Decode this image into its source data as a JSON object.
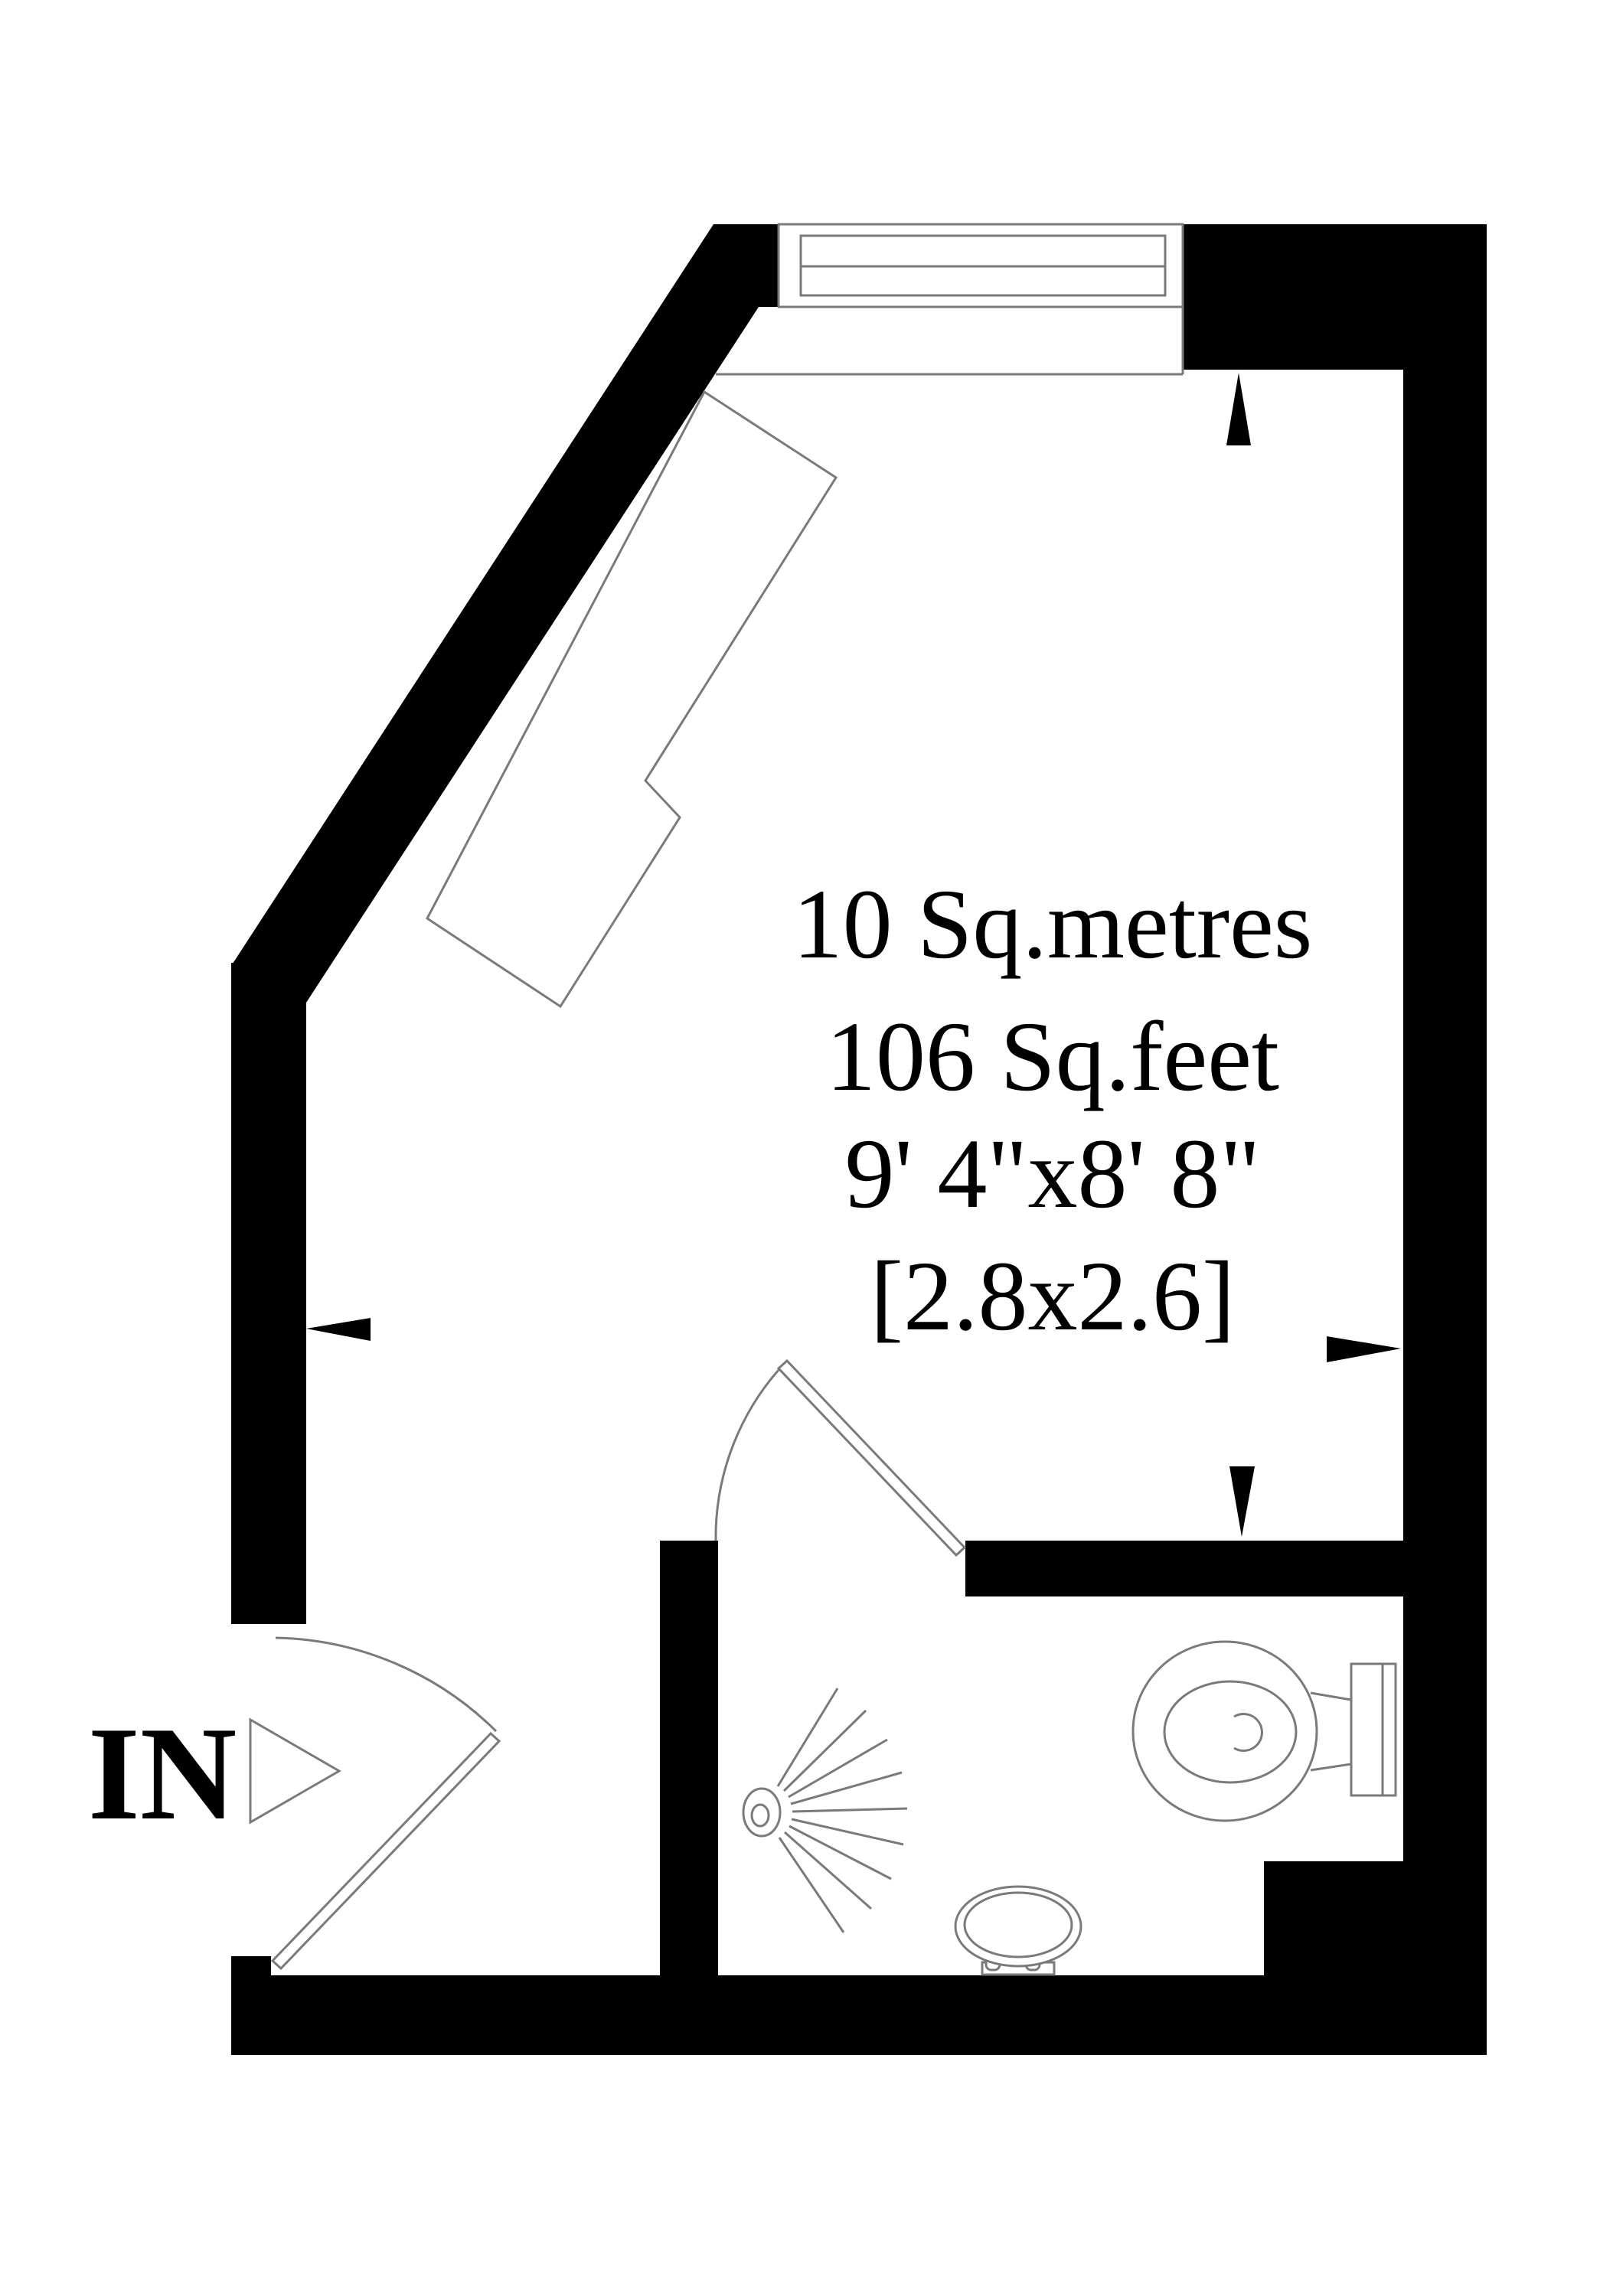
{
  "labels": {
    "area_metric": "10 Sq.metres",
    "area_imperial": "106 Sq.feet",
    "dimensions_imperial": "9' 4\"x8' 8\"",
    "dimensions_metric": "[2.8x2.6]",
    "entrance": "IN"
  },
  "colors": {
    "wall": "#000000",
    "fixture_line": "#7a7a7a",
    "text": "#000000",
    "background": "#ffffff"
  }
}
